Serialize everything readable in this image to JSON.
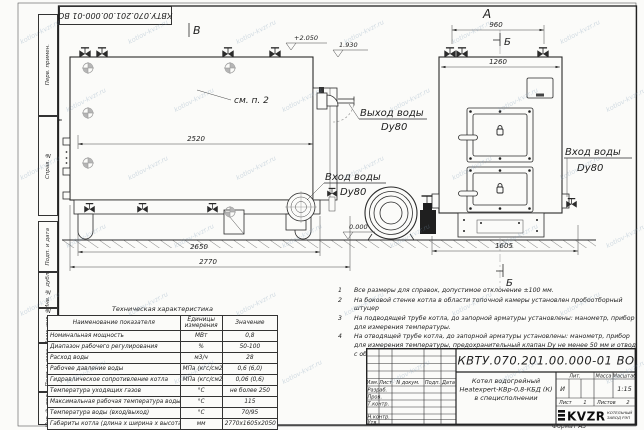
{
  "sheet": {
    "top_stamp": "КВТУ.070.201.00.000-01 ВО",
    "format_label": "Формат А3",
    "watermark": "kotlov-kvzr.ru",
    "frame_cells": [
      "Перв. примен.",
      "Справ. №",
      "Подп. и дата",
      "Инв. № дубл.",
      "Взам. инв. №",
      "Подп. и дата",
      "Инв. № подл."
    ]
  },
  "drawing": {
    "side_view": {
      "view_label": "В",
      "section_label": "А",
      "see_ref": "см. п. 2",
      "dims": {
        "body": "2520",
        "base": "2650",
        "overall": "2770"
      },
      "elevations": {
        "top": "+2.050",
        "mid": "1.930",
        "zero": "0.000"
      },
      "outlet_label": {
        "line1": "Выход воды",
        "line2": "Dy80"
      },
      "inlet_label": {
        "line1": "Вход воды",
        "line2": "Dy80"
      }
    },
    "front_view": {
      "view_label": "А",
      "section_label_top": "Б",
      "section_label_bottom": "Б",
      "dims": {
        "valves": "960",
        "body": "1260",
        "base": "1605"
      },
      "inlet_label": {
        "line1": "Вход воды",
        "line2": "Dy80"
      }
    }
  },
  "notes": [
    {
      "num": "1",
      "text": "Все размеры для справок, допустимое отклонение ±100 мм."
    },
    {
      "num": "2",
      "text": "На боковой стенке котла в области топочной камеры установлен пробоотборный штуцер"
    },
    {
      "num": "3",
      "text": "На подводящей трубе котла, до запорной арматуры установлены: манометр, прибор для измерения температуры."
    },
    {
      "num": "4",
      "text": "На отводящей трубе котла, до запорной арматуры установлены: манометр, прибор для измерения температуры, предохранительный клапан Dу не менее 50 мм и отвод с обратным клапаном Dу не менее 50 мм."
    }
  ],
  "spec_table": {
    "title": "Техническая характеристика",
    "headers": [
      "Наименование показателя",
      "Единицы измерения",
      "Значение"
    ],
    "rows": [
      [
        "Номинальная мощность",
        "МВт",
        "0,8"
      ],
      [
        "Диапазон рабочего регулирования",
        "%",
        "50-100"
      ],
      [
        "Расход воды",
        "м3/ч",
        "28"
      ],
      [
        "Рабочее давление воды",
        "МПа (кгс/см2)",
        "0,6 (6,0)"
      ],
      [
        "Гидравлическое сопротивление котла",
        "МПа (кгс/см2)",
        "0,06 (0,6)"
      ],
      [
        "Температура уходящих газов",
        "°С",
        "не более 250"
      ],
      [
        "Максимальная рабочая температура воды",
        "°С",
        "115"
      ],
      [
        "Температура воды (вход/выход)",
        "°С",
        "70/95"
      ],
      [
        "Габариты котла (длина х ширина х высота)",
        "мм",
        "2770х1605х2050"
      ]
    ]
  },
  "title_block": {
    "doc_number": "КВТУ.070.201.00.000-01 ВО",
    "product_lines": [
      "Котел водогрейный",
      "Heatexpert-КВр-0,8-КБД (К)",
      "в специсполнении"
    ],
    "rev_headers": [
      "Изм.",
      "Лист",
      "N докум.",
      "Подп.",
      "Дата"
    ],
    "sign_rows": [
      "Разраб.",
      "Пров.",
      "Т.контр.",
      "Н.контр.",
      "Утв."
    ],
    "lit_label": "Лит.",
    "lit_value": "И",
    "mass_label": "Масса",
    "scale_label": "Масштаб",
    "scale_value": "1:15",
    "sheet_label": "Лист",
    "sheet_value": "1",
    "sheets_label": "Листов",
    "sheets_value": "2",
    "company": {
      "logo": "KVZR",
      "name_line1": "КОТЕЛЬНЫЙ",
      "name_line2": "ЗАВОД РЭП"
    }
  }
}
